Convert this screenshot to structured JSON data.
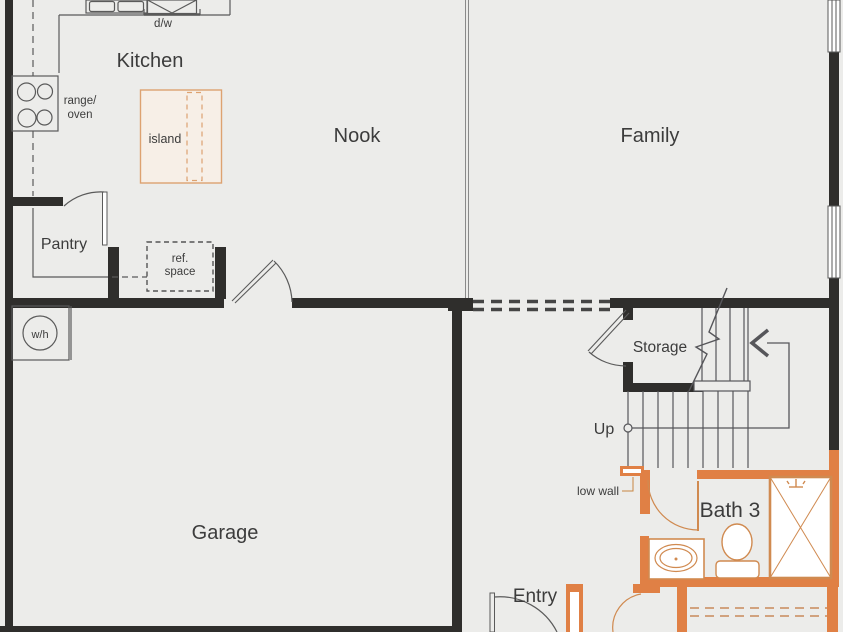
{
  "colors": {
    "background": "#ececea",
    "wall": "#2f2e2c",
    "thin_line": "#5a5a5a",
    "accent_wall": "#e08045",
    "accent_text": "#c9823d"
  },
  "rooms": {
    "kitchen": {
      "label": "Kitchen"
    },
    "nook": {
      "label": "Nook"
    },
    "family": {
      "label": "Family"
    },
    "pantry": {
      "label": "Pantry"
    },
    "garage": {
      "label": "Garage"
    },
    "storage": {
      "label": "Storage"
    },
    "entry": {
      "label": "Entry"
    },
    "bath3": {
      "label": "Bath 3"
    }
  },
  "annotations": {
    "up": "Up",
    "low_wall": "low wall",
    "island": "island",
    "dishwasher": "d/w",
    "range_oven": [
      "range/",
      "oven"
    ],
    "ref_space": [
      "ref.",
      "space"
    ],
    "water_heater": "w/h"
  }
}
